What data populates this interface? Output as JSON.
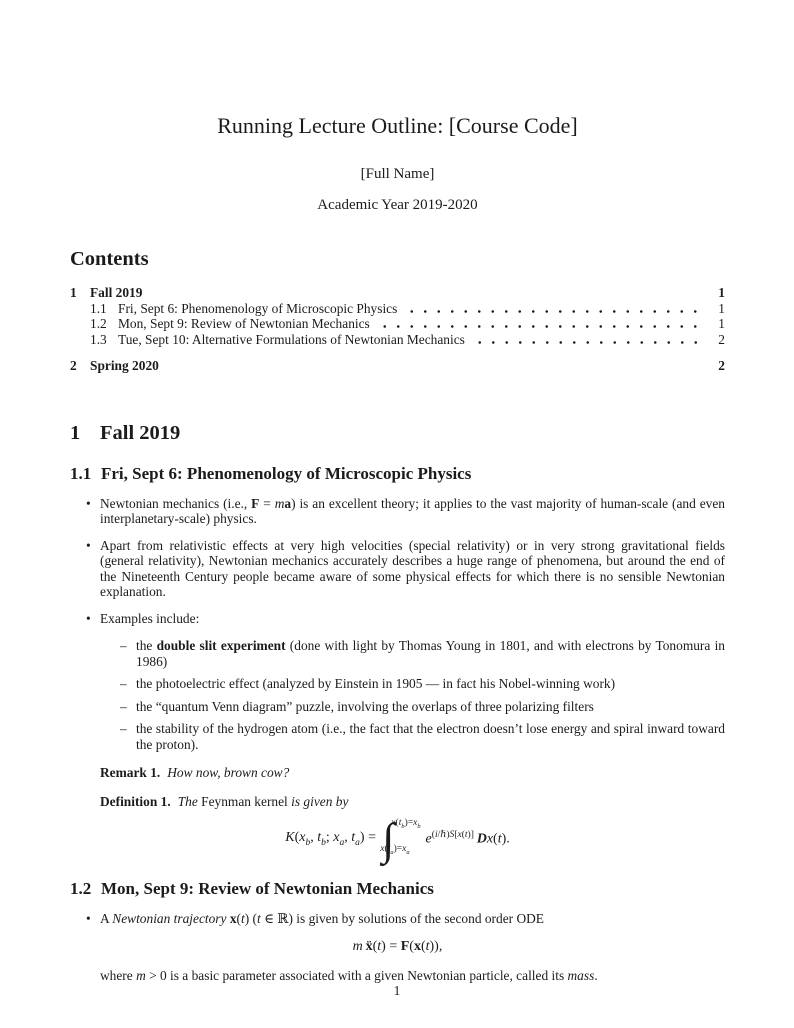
{
  "header": {
    "title": "Running Lecture Outline: [Course Code]",
    "author": "[Full Name]",
    "date": "Academic Year 2019-2020"
  },
  "contents": {
    "heading": "Contents",
    "entries": [
      {
        "number": "1",
        "label": "Fall 2019",
        "page": "1",
        "level": 1
      },
      {
        "number": "1.1",
        "label": "Fri, Sept 6: Phenomenology of Microscopic Physics",
        "page": "1",
        "level": 2
      },
      {
        "number": "1.2",
        "label": "Mon, Sept 9: Review of Newtonian Mechanics",
        "page": "1",
        "level": 2
      },
      {
        "number": "1.3",
        "label": "Tue, Sept 10: Alternative Formulations of Newtonian Mechanics",
        "page": "2",
        "level": 2
      },
      {
        "number": "2",
        "label": "Spring 2020",
        "page": "2",
        "level": 1
      }
    ]
  },
  "body": {
    "section1": {
      "number": "1",
      "title": "Fall 2019"
    },
    "sub11": {
      "number": "1.1",
      "title": "Fri, Sept 6: Phenomenology of Microscopic Physics",
      "bullets": [
        {
          "html": "Newtonian mechanics (i.e., <b>F</b> = <i>m</i><b>a</b>) is an excellent theory; it applies to the vast majority of human-scale (and even interplanetary-scale) physics."
        },
        {
          "html": "Apart from relativistic effects at very high velocities (special relativity) or in very strong gravitational fields (general relativity), Newtonian mechanics accurately describes a huge range of phenomena, but around the end of the Nineteenth Century people became aware of some physical effects for which there is no sensible Newtonian explanation."
        },
        {
          "html": "Examples include:"
        }
      ],
      "subbullets": [
        {
          "html": "the <b>double slit experiment</b> (done with light by Thomas Young in 1801, and with electrons by Tonomura in 1986)"
        },
        {
          "html": "the photoelectric effect (analyzed by Einstein in 1905 — in fact his Nobel-winning work)"
        },
        {
          "html": "the “quantum Venn diagram” puzzle, involving the overlaps of three polarizing filters"
        },
        {
          "html": "the stability of the hydrogen atom (i.e., the fact that the electron doesn’t lose energy and spiral inward toward the proton)."
        }
      ],
      "remark": {
        "label": "Remark 1.",
        "text": "How now, brown cow?"
      },
      "definition": {
        "label": "Definition 1.",
        "body_html": "<i>The</i> Feynman kernel <i>is given by</i>"
      },
      "formula": {
        "lhs_html": "<i>K</i>(<i>x<sub>b</sub></i>, <i>t<sub>b</sub></i>; <i>x<sub>a</sub></i>, <i>t<sub>a</sub></i>) =",
        "upper_html": "<i>x</i>(<i>t<sub>b</sub></i>)=<i>x<sub>b</sub></i>",
        "lower_html": "<i>x</i>(<i>t<sub>a</sub></i>)=<i>x<sub>a</sub></i>",
        "integrand_html": "<i>e</i><sup>(<i>i</i>/ℏ)<i>S</i>[<i>x</i>(<i>t</i>)]</sup> <i><b>D</b>x</i>(<i>t</i>)."
      }
    },
    "sub12": {
      "number": "1.2",
      "title": "Mon, Sept 9: Review of Newtonian Mechanics",
      "bullet_html": "A <i>Newtonian trajectory</i> <b>x</b>(<i>t</i>) (<i>t</i> ∈ ℝ) is given by solutions of the second order ODE",
      "formula_html": "<i>m</i> <b>ẍ</b>(<i>t</i>) = <b>F</b>(<b>x</b>(<i>t</i>)),",
      "after_html": "where <i>m</i> &gt; 0 is a basic parameter associated with a given Newtonian particle, called its <i>mass</i>."
    }
  },
  "footer": {
    "page_number": "1"
  }
}
